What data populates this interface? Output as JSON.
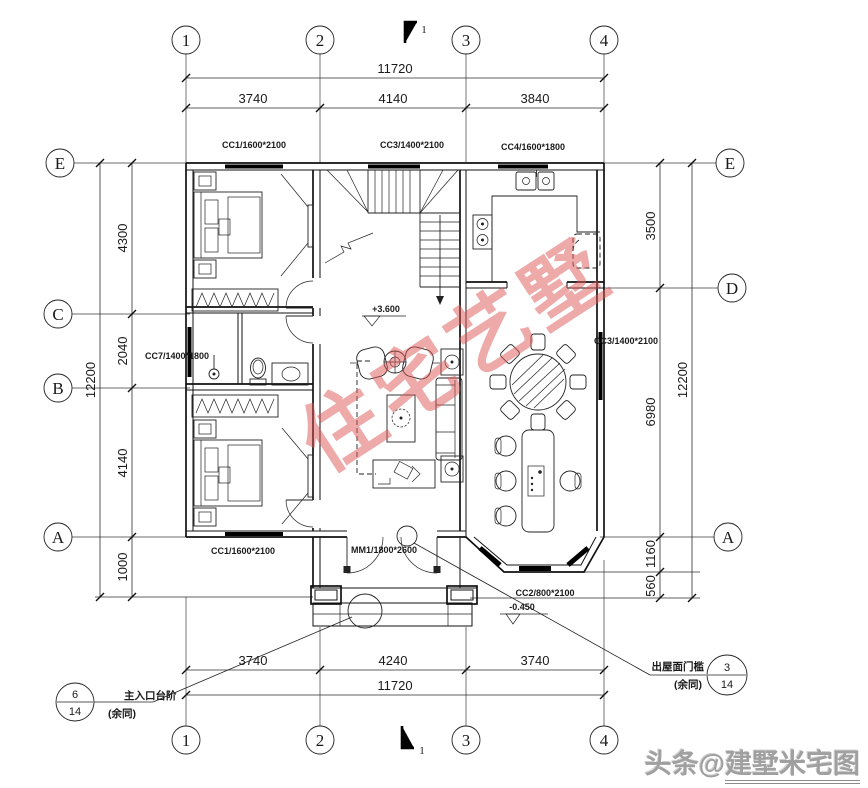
{
  "axes": {
    "cols": [
      "1",
      "2",
      "3",
      "4"
    ],
    "rows_left": [
      "E",
      "C",
      "B",
      "A"
    ],
    "rows_right": [
      "E",
      "D",
      "A"
    ]
  },
  "dims": {
    "top_overall": "11720",
    "top_chain": [
      "3740",
      "4140",
      "3840"
    ],
    "bottom_chain": [
      "3740",
      "4240",
      "3740"
    ],
    "bottom_overall": "11720",
    "left_chain": [
      "4300",
      "2040",
      "4140",
      "1000"
    ],
    "left_overall": "12200",
    "right_chain": [
      "3500",
      "6980",
      "1160",
      "560"
    ],
    "right_overall": "12200"
  },
  "openings": {
    "cc1_top": "CC1/1600*2100",
    "cc3_top": "CC3/1400*2100",
    "cc4_top": "CC4/1600*1800",
    "cc7_left": "CC7/1400*1800",
    "cc1_bottom": "CC1/1600*2100",
    "cc3_right": "CC3/1400*2100",
    "mm1_entry": "MM1/1800*2600",
    "cc2_bay": "CC2/800*2100"
  },
  "levels": {
    "floor": "+3.600",
    "porch": "-0.450"
  },
  "annotations": {
    "entry_steps": {
      "num": "6",
      "den": "14",
      "label": "主入口台阶",
      "note": "(余同)"
    },
    "roof_threshold": {
      "num": "3",
      "den": "14",
      "label": "出屋面门槛",
      "note": "(余同)"
    }
  },
  "section_marks": {
    "top": "1",
    "bottom": "1"
  },
  "watermarks": {
    "center": "住宅艺墅",
    "corner_prefix": "头条@",
    "corner_suffix": "建墅米宅图"
  },
  "colors": {
    "line": "#1a1a1a",
    "watermark_red": "#de5454",
    "corner_gray": "#a0a0a0"
  }
}
